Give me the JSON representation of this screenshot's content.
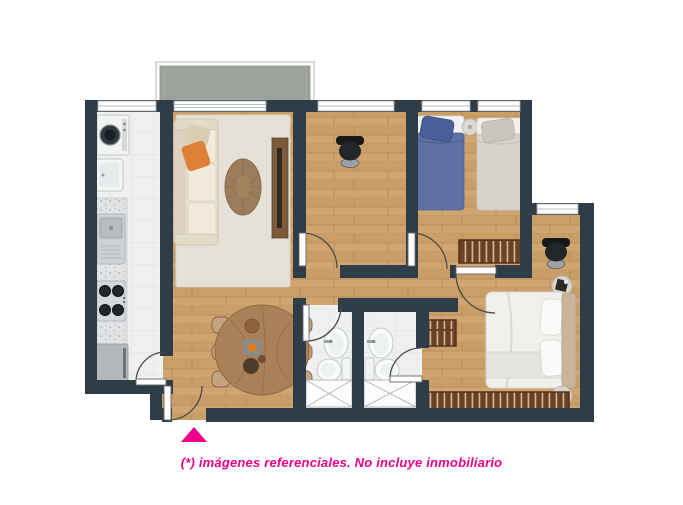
{
  "caption": {
    "text": "(*) imágenes referenciales. No incluye inmobiliario"
  },
  "entrance_marker": {
    "symbol": "triangle-up",
    "color": "#ec008c"
  },
  "palette": {
    "accent_pink": "#ec008c",
    "wall": "#2e3d47",
    "wood_floor": "#cfa473",
    "tile_floor": "#eff1f1",
    "balcony_slab": "#9ea29d",
    "closet_wood": "#6b4124",
    "sofa_cream": "#e9e1d2",
    "pillow_orange": "#dd8038",
    "bed_blue": "#5d72a3",
    "bed_beige": "#d7d3ca",
    "rug": "#e6e1d7",
    "dining_wood": "#aa8058"
  },
  "plan": {
    "type": "apartment-floor-plan",
    "rooms": [
      {
        "name": "balcony"
      },
      {
        "name": "laundry",
        "furniture": [
          "washing-machine",
          "laundry-tub"
        ]
      },
      {
        "name": "kitchen",
        "furniture": [
          "counter",
          "sink",
          "stove",
          "fridge"
        ]
      },
      {
        "name": "living-room",
        "furniture": [
          "sofa",
          "rug",
          "coffee-table",
          "tv-console"
        ]
      },
      {
        "name": "study",
        "furniture": [
          "office-chair"
        ]
      },
      {
        "name": "bedroom-2",
        "furniture": [
          "single-bed-blue",
          "single-bed-beige",
          "nightstand",
          "closet-bench"
        ]
      },
      {
        "name": "main-bedroom",
        "furniture": [
          "double-bed",
          "headboard",
          "desk-chair",
          "side-table",
          "nightstand",
          "wardrobe",
          "closet"
        ]
      },
      {
        "name": "dining-room",
        "furniture": [
          "dining-table",
          "chairs-x6"
        ]
      },
      {
        "name": "bathroom-1",
        "furniture": [
          "sink",
          "toilet",
          "shower"
        ]
      },
      {
        "name": "bathroom-2",
        "furniture": [
          "sink",
          "toilet",
          "shower"
        ]
      }
    ],
    "doors": 7,
    "entrance": "bottom-left"
  }
}
